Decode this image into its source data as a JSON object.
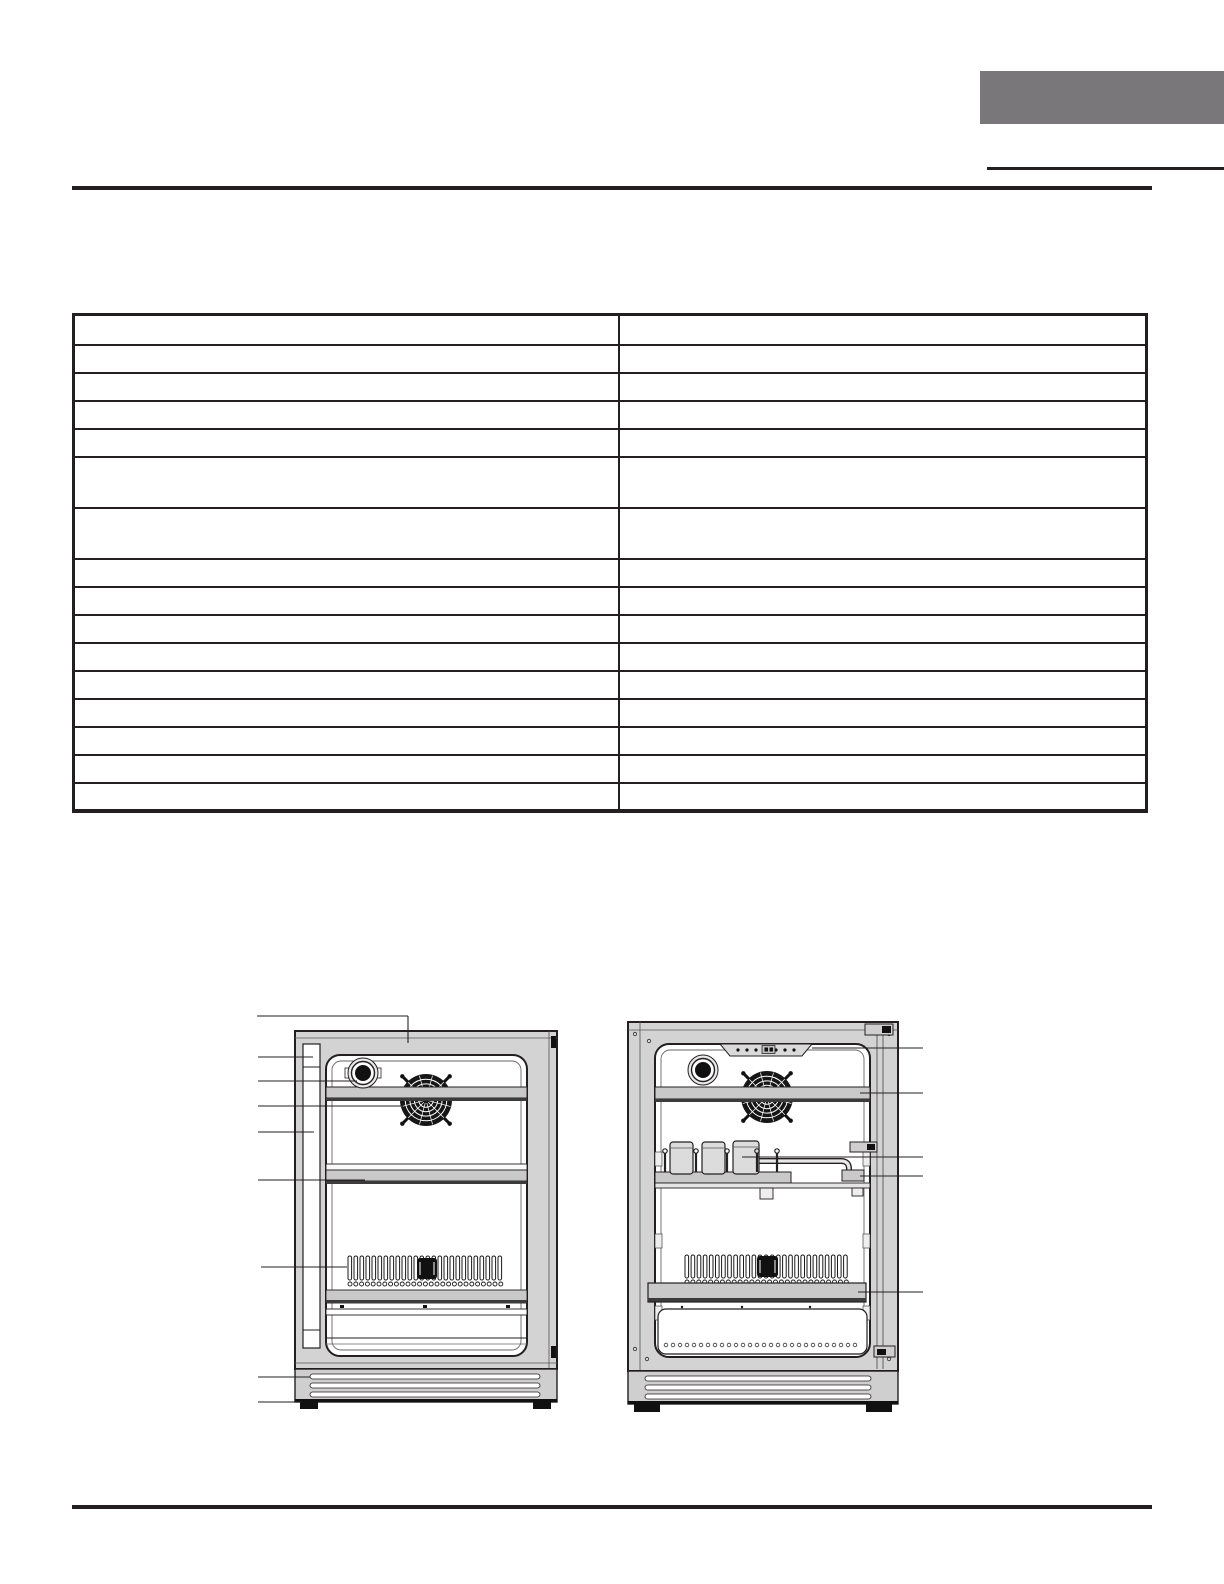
{
  "page": {
    "width": 1224,
    "height": 1584
  },
  "colors": {
    "page": "#ffffff",
    "ink": "#231f20",
    "tab_gray": "#7a777a",
    "cabinet": "#d3d3d3",
    "panel_gray": "#c9c9c9",
    "kick_gray": "#cfcfcf",
    "dark_strip": "#3b3b3b",
    "fan_black": "#161616",
    "can_fill": "#dcdcdc"
  },
  "table": {
    "columns": 2,
    "column_widths": [
      "50.75%",
      "49.25%"
    ],
    "rows": [
      {
        "h": 28,
        "cells": [
          "",
          ""
        ]
      },
      {
        "h": 28,
        "cells": [
          "",
          ""
        ]
      },
      {
        "h": 28,
        "cells": [
          "",
          ""
        ]
      },
      {
        "h": 28,
        "cells": [
          "",
          ""
        ]
      },
      {
        "h": 28,
        "cells": [
          "",
          ""
        ]
      },
      {
        "h": 51,
        "cells": [
          "",
          ""
        ]
      },
      {
        "h": 51,
        "cells": [
          "",
          ""
        ]
      },
      {
        "h": 28,
        "cells": [
          "",
          ""
        ]
      },
      {
        "h": 28,
        "cells": [
          "",
          ""
        ]
      },
      {
        "h": 28,
        "cells": [
          "",
          ""
        ]
      },
      {
        "h": 28,
        "cells": [
          "",
          ""
        ]
      },
      {
        "h": 28,
        "cells": [
          "",
          ""
        ]
      },
      {
        "h": 28,
        "cells": [
          "",
          ""
        ]
      },
      {
        "h": 28,
        "cells": [
          "",
          ""
        ]
      },
      {
        "h": 28,
        "cells": [
          "",
          ""
        ]
      },
      {
        "h": 27,
        "cells": [
          "",
          ""
        ]
      }
    ]
  },
  "diagrams": {
    "left": {
      "fan": {
        "cx": 171,
        "cy": 92,
        "r": 26
      },
      "coils": {
        "x": 93,
        "y": 248,
        "count": 26,
        "spacing": 6,
        "loop_w": 3.6,
        "loop_h": 24,
        "box": {
          "x": 162,
          "y": 250,
          "w": 20,
          "h": 21
        },
        "circles": {
          "x": 95,
          "y": 276,
          "count": 27,
          "spacing": 5.8,
          "r": 2
        }
      },
      "callouts": [
        {
          "target": "door-top",
          "segments": [
            [
              2,
              8,
              153,
              8
            ],
            [
              153,
              8,
              153,
              35
            ]
          ]
        },
        {
          "target": "door-handle",
          "segments": [
            [
              3,
              49,
              58,
              49
            ]
          ]
        },
        {
          "target": "interior-light",
          "segments": [
            [
              3,
              73,
              102,
              73
            ]
          ]
        },
        {
          "target": "circulation-fan",
          "segments": [
            [
              3,
              98,
              148,
              98
            ]
          ]
        },
        {
          "target": "door-frame",
          "segments": [
            [
              3,
              124,
              59,
              124
            ]
          ]
        },
        {
          "target": "glass-shelf",
          "segments": [
            [
              3,
              172,
              110,
              172
            ]
          ]
        },
        {
          "target": "evaporator-coil",
          "segments": [
            [
              6,
              259,
              92,
              259
            ]
          ]
        },
        {
          "target": "kickplate",
          "segments": [
            [
              3,
              369,
              55,
              369
            ]
          ]
        },
        {
          "target": "leveling-foot",
          "segments": [
            [
              3,
              394,
              47,
              394
            ]
          ]
        }
      ]
    },
    "right": {
      "fan": {
        "cx": 147,
        "cy": 85,
        "r": 26
      },
      "coils": {
        "x": 65,
        "y": 243,
        "count": 27,
        "spacing": 6.1,
        "loop_w": 3.6,
        "loop_h": 23,
        "box": {
          "x": 137,
          "y": 244,
          "w": 21,
          "h": 21
        },
        "circles": {
          "x": 67,
          "y": 270,
          "count": 28,
          "spacing": 5.9,
          "r": 2
        }
      },
      "scallops": {
        "x": 46,
        "y": 333,
        "count": 28,
        "spacing": 7,
        "r": 1.8
      },
      "pins": {
        "y_top": 139,
        "y_bottom": 160,
        "xs": [
          45,
          76,
          107,
          137,
          157
        ]
      },
      "callouts": [
        {
          "target": "control-panel",
          "segments": [
            [
              192,
              36,
              303,
              36
            ]
          ]
        },
        {
          "target": "top-shelf",
          "segments": [
            [
              240,
              81,
              303,
              81
            ]
          ]
        },
        {
          "target": "can-rack",
          "segments": [
            [
              122,
              145,
              303,
              145
            ]
          ]
        },
        {
          "target": "rack-shelf",
          "segments": [
            [
              240,
              164,
              303,
              164
            ]
          ]
        },
        {
          "target": "bottom-shelf",
          "segments": [
            [
              238,
              280,
              303,
              280
            ]
          ]
        }
      ]
    }
  }
}
